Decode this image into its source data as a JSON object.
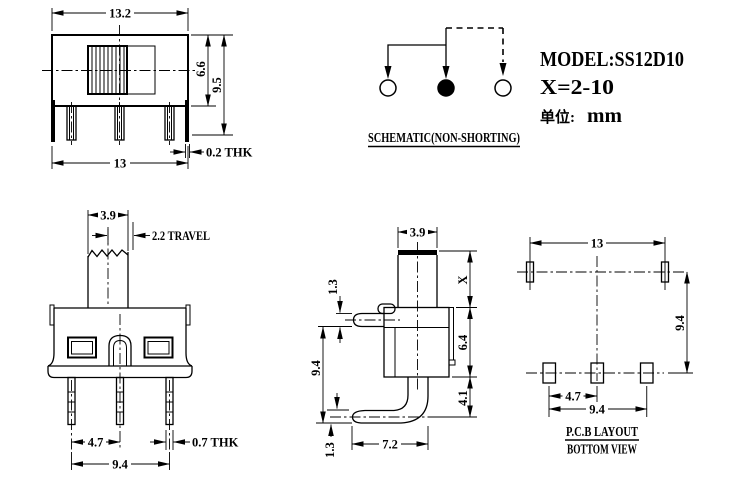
{
  "front_view": {
    "dim_width_top": "13.2",
    "dim_body_height": "6.6",
    "dim_total_height": "9.5",
    "dim_width_bottom": "13",
    "dim_plate_thickness": "0.2 THK"
  },
  "actuator_view": {
    "dim_knob_width": "3.9",
    "dim_travel": "2.2 TRAVEL",
    "dim_pin_pitch": "4.7",
    "dim_pin_span": "9.4",
    "dim_pin_thickness": "0.7 THK"
  },
  "side_view": {
    "dim_knob_width": "3.9",
    "dim_pin_thickness": "1.3",
    "dim_pin_to_foot": "9.4",
    "dim_foot_thickness": "1.3",
    "dim_foot_length": "7.2",
    "dim_knob_height": "X",
    "dim_body_height": "6.4",
    "dim_foot_drop": "4.1"
  },
  "pcb_view": {
    "dim_mount_span": "13",
    "dim_row_gap": "9.4",
    "dim_pad_pitch": "4.7",
    "dim_pad_span": "9.4",
    "title": "P.C.B LAYOUT",
    "subtitle": "BOTTOM VIEW"
  },
  "schematic": {
    "caption": "SCHEMATIC(NON-SHORTING)"
  },
  "info": {
    "model": "MODEL:SS12D10",
    "x_range": "X=2-10",
    "unit_label": "单位:",
    "unit_value": "mm"
  }
}
